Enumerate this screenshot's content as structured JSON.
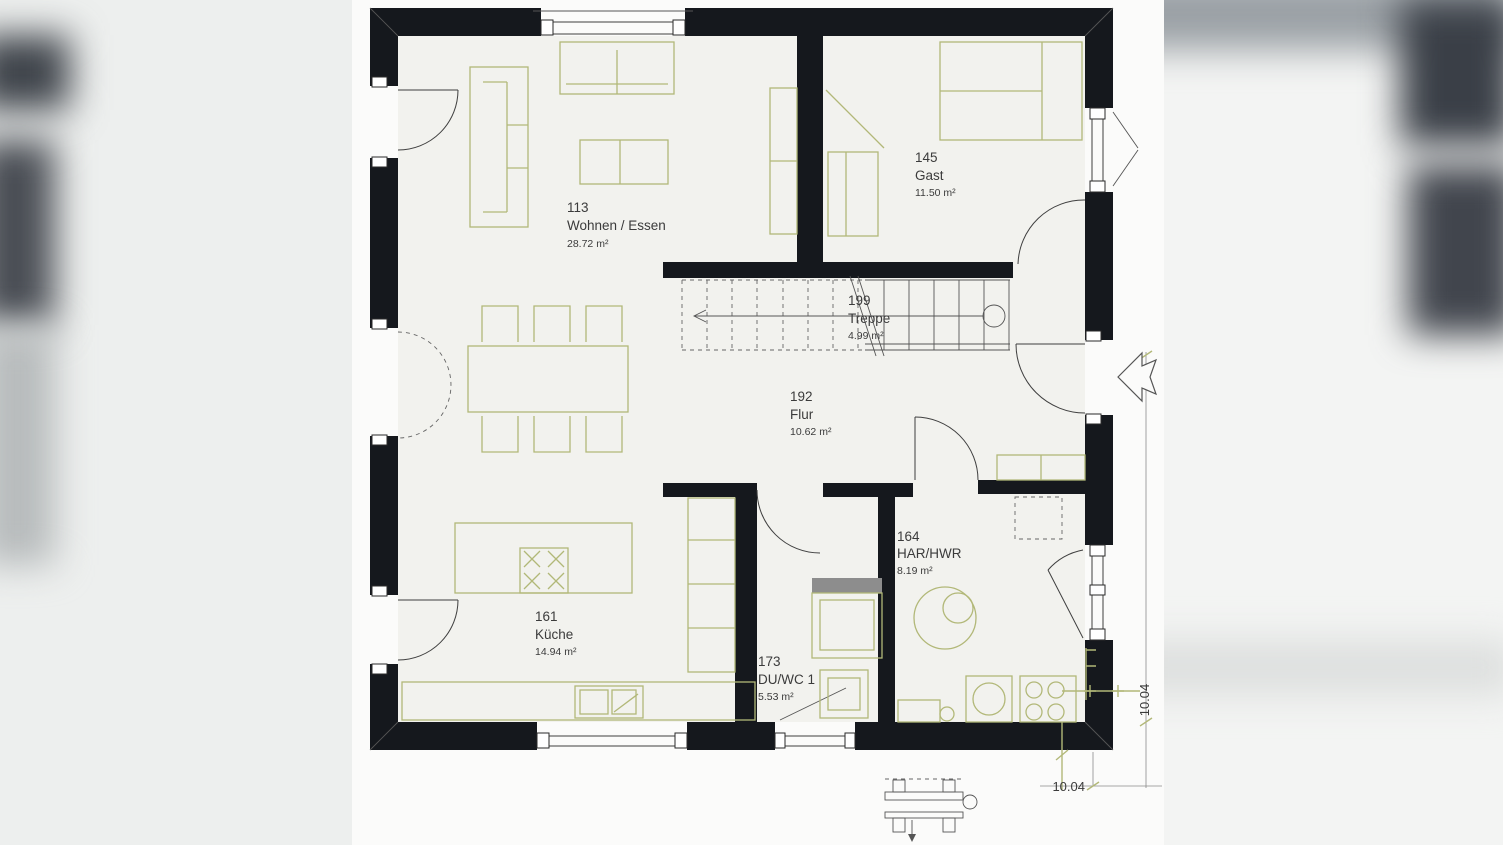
{
  "plan": {
    "title": "Erdgeschoss Grundriss",
    "rooms": [
      {
        "number": "113",
        "name": "Wohnen / Essen",
        "area": "28.72 m²"
      },
      {
        "number": "145",
        "name": "Gast",
        "area": "11.50 m²"
      },
      {
        "number": "199",
        "name": "Treppe",
        "area": "4.99 m²"
      },
      {
        "number": "192",
        "name": "Flur",
        "area": "10.62 m²"
      },
      {
        "number": "161",
        "name": "Küche",
        "area": "14.94 m²"
      },
      {
        "number": "173",
        "name": "DU/WC 1",
        "area": "5.53 m²"
      },
      {
        "number": "164",
        "name": "HAR/HWR",
        "area": "8.19 m²"
      }
    ],
    "dimensions": {
      "right": "10.04",
      "bottom": "10.04"
    },
    "colors": {
      "wall": "#15181d",
      "furniture": "#b2b878",
      "floor": "#f2f2ee",
      "text": "#3b3b3b",
      "dimension_accent": "#b2b878"
    }
  }
}
